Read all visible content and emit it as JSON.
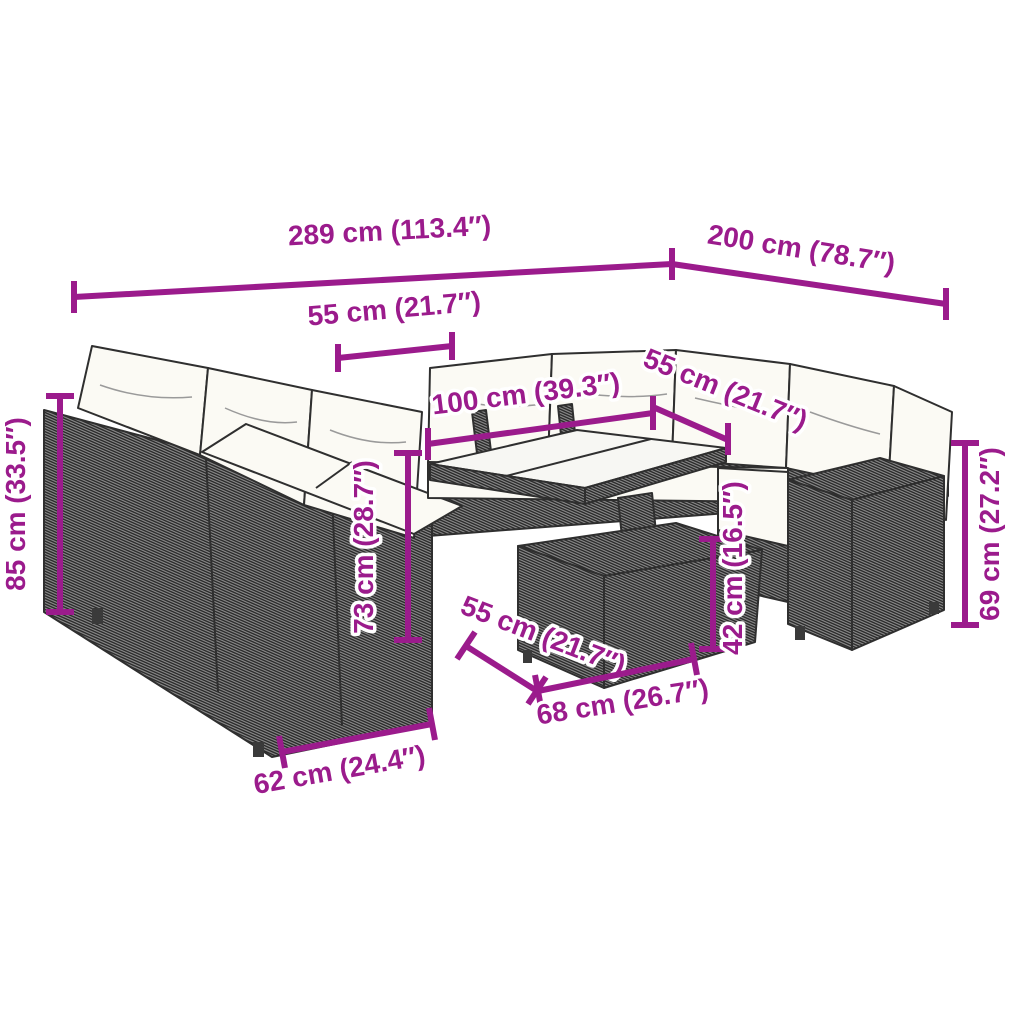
{
  "alt_text": "Dimension diagram of a U-shaped poly rattan garden lounge set with cushions and a height-adjustable glass-top table",
  "colors": {
    "background": "#ffffff",
    "dimension_accent": "#9b1b8c",
    "sketch_outline": "#2f2f2f",
    "cushion_fill": "#fbfaf4",
    "glass_fill": "#f7f7f3"
  },
  "dimensions": [
    {
      "name": "sofa-total-width",
      "label": "289 cm (113.4″)"
    },
    {
      "name": "sofa-total-depth",
      "label": "200 cm (78.7″)"
    },
    {
      "name": "back-seat-width",
      "label": "55 cm (21.7″)"
    },
    {
      "name": "table-top-length",
      "label": "100 cm (39.3″)"
    },
    {
      "name": "right-seat-width",
      "label": "55 cm (21.7″)"
    },
    {
      "name": "sofa-height",
      "label": "85 cm (33.5″)"
    },
    {
      "name": "table-height-max",
      "label": "73 cm (28.7″)"
    },
    {
      "name": "table-height-min",
      "label": "42 cm (16.5″)"
    },
    {
      "name": "side-module-height",
      "label": "69 cm (27.2″)"
    },
    {
      "name": "table-top-depth",
      "label": "55 cm (21.7″)"
    },
    {
      "name": "table-base-width",
      "label": "68 cm (26.7″)"
    },
    {
      "name": "front-module-width",
      "label": "62 cm (24.4″)"
    }
  ]
}
